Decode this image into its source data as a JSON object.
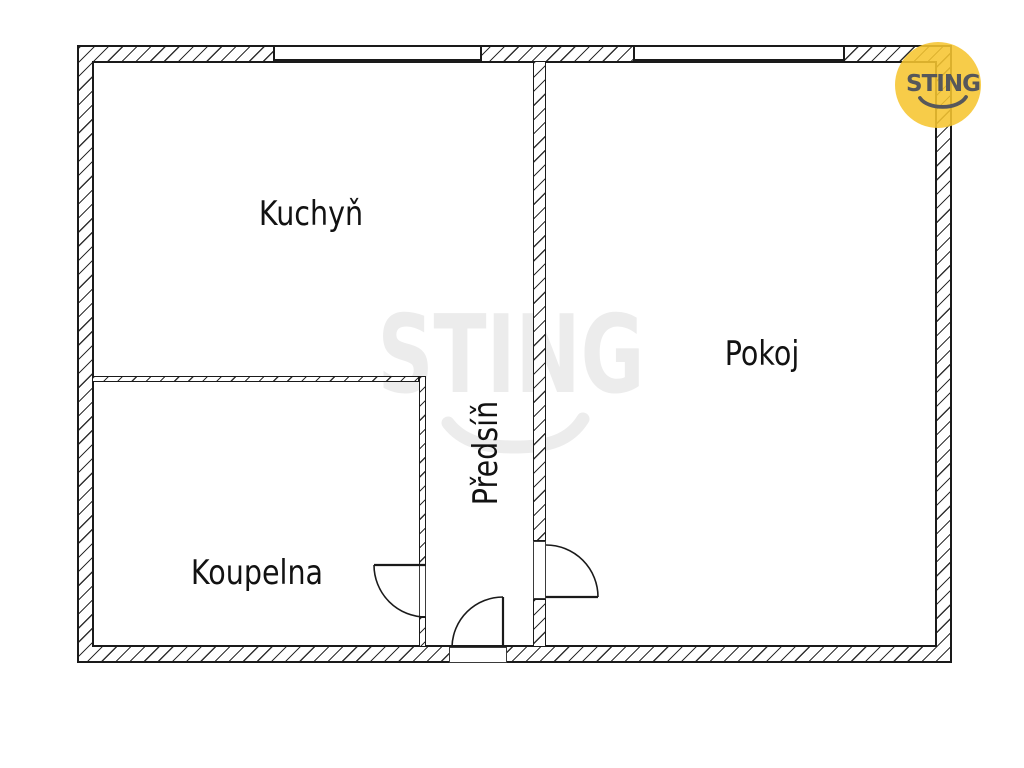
{
  "floorplan": {
    "rooms": [
      {
        "id": "kuchyn",
        "label": "Kuchyň"
      },
      {
        "id": "pokoj",
        "label": "Pokoj"
      },
      {
        "id": "koupelna",
        "label": "Koupelna"
      },
      {
        "id": "predsin",
        "label": "Předsíň"
      }
    ],
    "watermark": {
      "text": "STING"
    },
    "logo": {
      "text": "STING",
      "circle_color": "#F6C530",
      "text_color": "#56575B"
    },
    "colors": {
      "background": "#FFFFFF",
      "wall_line": "#1A1A1A",
      "watermark_gray": "#ECECEC"
    }
  }
}
